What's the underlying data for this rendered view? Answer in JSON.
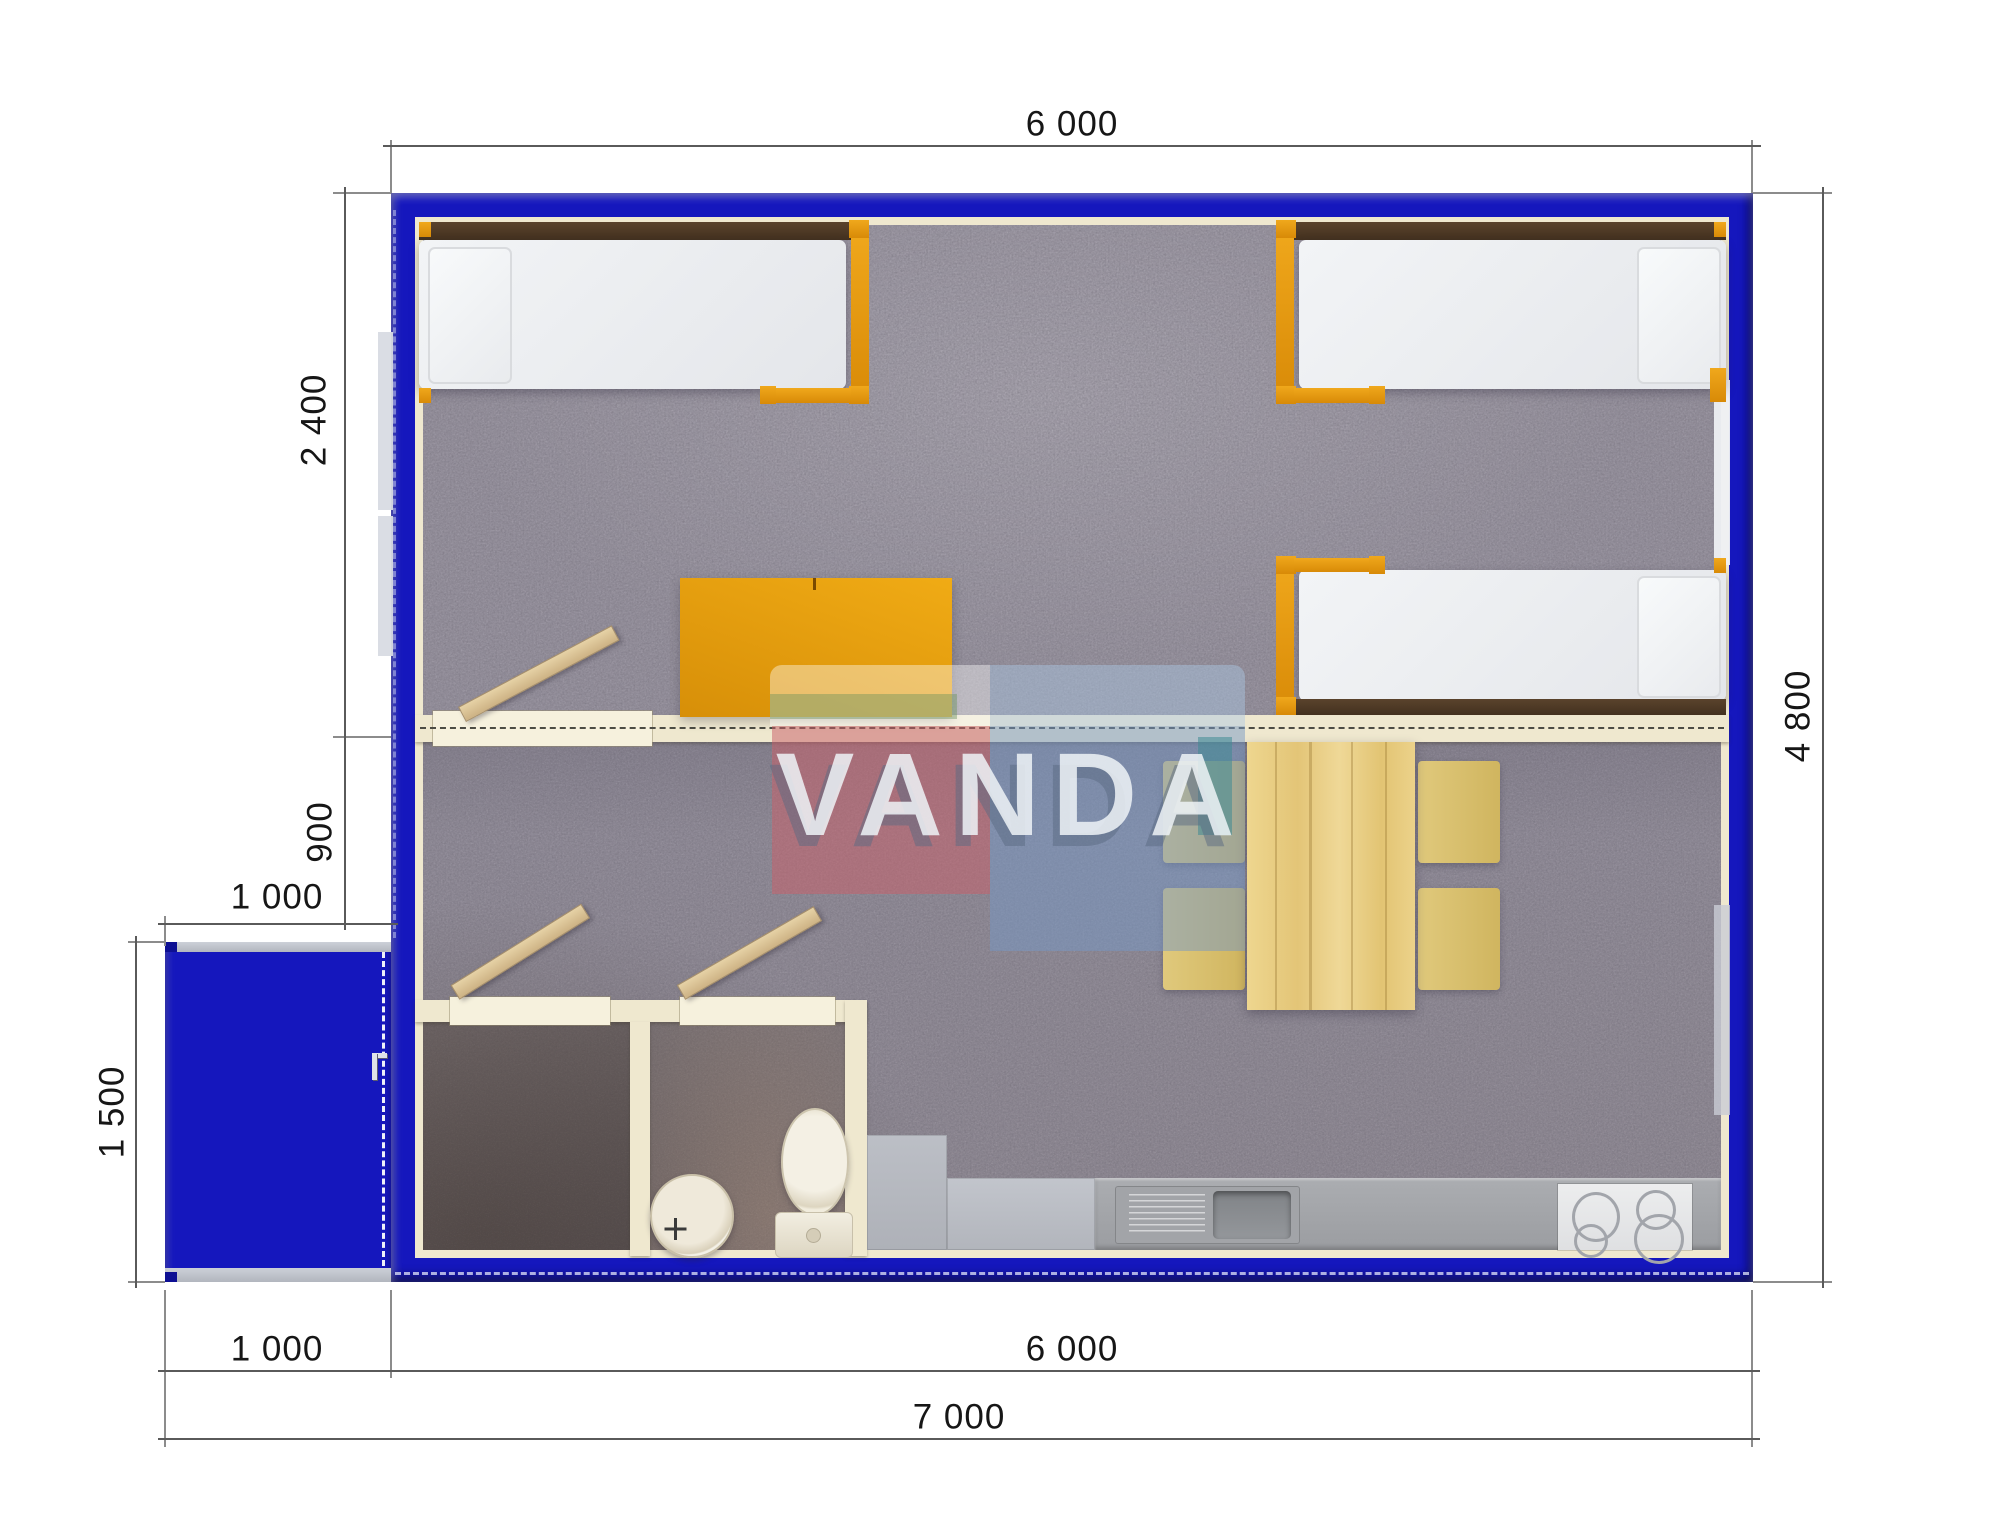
{
  "dimensions": {
    "top_width": "6 000",
    "left_bedroom_depth": "2 400",
    "left_middle_depth": "900",
    "porch_width_top": "1 000",
    "porch_height": "1 500",
    "right_total_depth": "4 800",
    "bottom_porch_width": "1 000",
    "bottom_main_width": "6 000",
    "bottom_total_width": "7 000"
  },
  "watermark": {
    "brand": "VANDA"
  },
  "rooms": {
    "bedroom": "sleeping area with three single beds and desk",
    "living": "dining area with table and four chairs",
    "bathroom": "WC with sink and toilet",
    "kitchen": "counter with sink and four-burner stove",
    "porch": "entrance porch"
  },
  "icons": {
    "toilet": "toilet-top-view",
    "sink": "round-basin-with-cross-faucet",
    "stove": "four-burner-hob",
    "door": "open-door-leaf",
    "handle": "door-handle"
  },
  "colors": {
    "wall-blue": "#1517BD",
    "wall-blue-dark": "#0D0F93",
    "cream": "#EFE8CF",
    "orange": "#E79A12",
    "pine": "#E8CD8A",
    "mustard": "#D4BA66",
    "carpet": "#9B96A2",
    "carpet-dark": "#837E8A",
    "counter": "#A3A5A9",
    "mattress": "#EDEFF2",
    "headboard": "#4E3A27",
    "dim-line": "#5A5A5A",
    "ext-line": "#8C8C8C",
    "text": "#161616",
    "watermark-red": "#CA6069",
    "watermark-blue": "#7698C6",
    "watermark-teal": "#408A94"
  }
}
